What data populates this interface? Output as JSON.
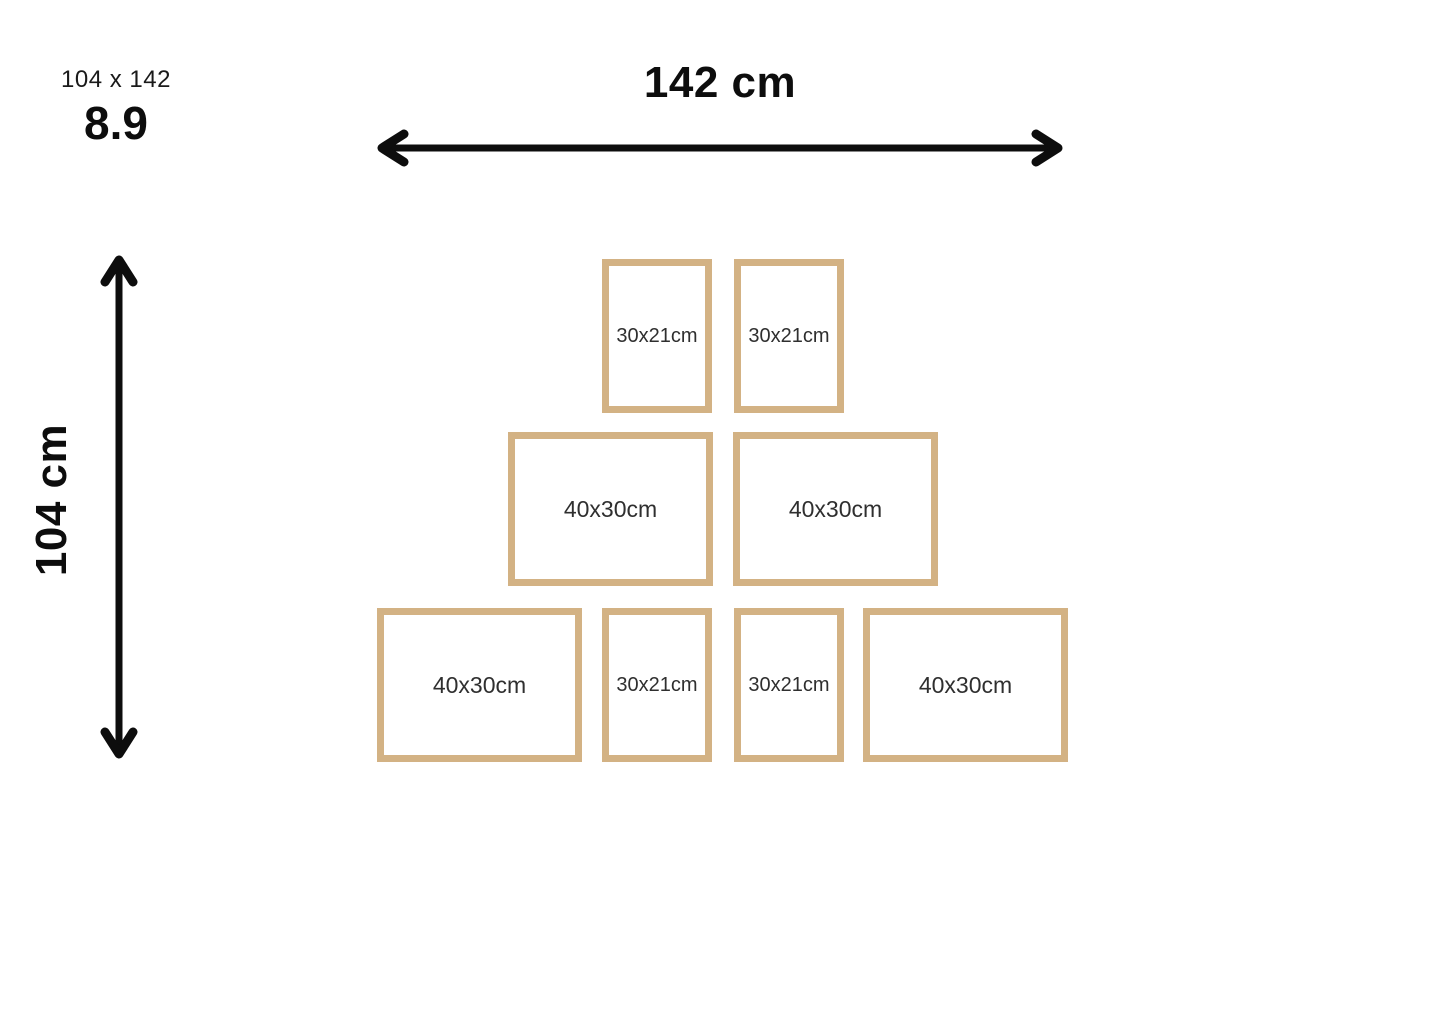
{
  "header": {
    "size_summary": "104 x 142",
    "rating": "8.9"
  },
  "dimensions": {
    "width_label": "142 cm",
    "height_label": "104 cm"
  },
  "frames": [
    {
      "label": "30x21cm"
    },
    {
      "label": "30x21cm"
    },
    {
      "label": "40x30cm"
    },
    {
      "label": "40x30cm"
    },
    {
      "label": "40x30cm"
    },
    {
      "label": "30x21cm"
    },
    {
      "label": "30x21cm"
    },
    {
      "label": "40x30cm"
    }
  ],
  "colors": {
    "frame_border": "#d3b284",
    "arrow": "#0d0d0d",
    "frame_label_text": "#2f2f2f",
    "heading_text": "#0d0d0d",
    "background": "#ffffff"
  }
}
